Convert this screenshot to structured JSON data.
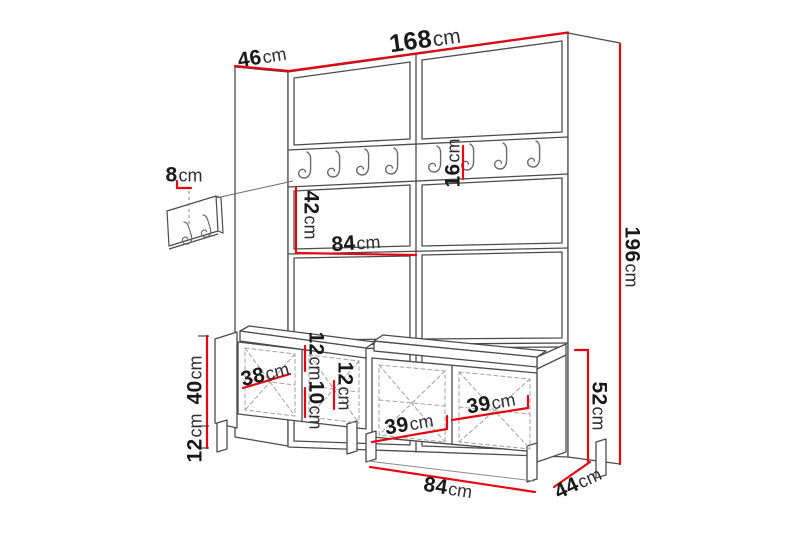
{
  "page": {
    "background": "#ffffff"
  },
  "colors": {
    "dimension_red": "#e30613",
    "outline": "#4b4b4b",
    "dashed_detail": "#a3a3a3",
    "text": "#191919"
  },
  "diagram": {
    "kind": "furniture-dimension-drawing",
    "subject": "Hallway set: tall upholstered coat-rack panel with hook rails, small wall hook strip, and two shoe benches with seat cushions on legs",
    "units": "cm",
    "overall": {
      "total_width": "168cm",
      "total_height": "196cm",
      "side_depth_top": "46cm",
      "bench_depth": "44cm",
      "bench_total_height": "52cm"
    },
    "labels": [
      {
        "id": "side-depth",
        "num": "46",
        "unit": "cm"
      },
      {
        "id": "total-width",
        "num": "168",
        "unit": "cm"
      },
      {
        "id": "wall-strip-height",
        "num": "8",
        "unit": "cm"
      },
      {
        "id": "panel-section-height",
        "num": "42",
        "unit": "cm"
      },
      {
        "id": "panel-half-width",
        "num": "84",
        "unit": "cm"
      },
      {
        "id": "hook-rail-height",
        "num": "16",
        "unit": "cm"
      },
      {
        "id": "total-height",
        "num": "196",
        "unit": "cm"
      },
      {
        "id": "bench-body-height",
        "num": "40",
        "unit": "cm"
      },
      {
        "id": "bench-leg-height",
        "num": "12",
        "unit": "cm"
      },
      {
        "id": "door-width-left",
        "num": "38",
        "unit": "cm"
      },
      {
        "id": "shelf-space-top",
        "num": "12",
        "unit": "cm"
      },
      {
        "id": "shelf-space-bottom",
        "num": "10",
        "unit": "cm"
      },
      {
        "id": "shelf-space-right",
        "num": "12",
        "unit": "cm"
      },
      {
        "id": "door-width-39-left",
        "num": "39",
        "unit": "cm"
      },
      {
        "id": "door-width-39-right",
        "num": "39",
        "unit": "cm"
      },
      {
        "id": "bench-total-height",
        "num": "52",
        "unit": "cm"
      },
      {
        "id": "bench-width",
        "num": "84",
        "unit": "cm"
      },
      {
        "id": "bench-depth",
        "num": "44",
        "unit": "cm"
      }
    ]
  }
}
